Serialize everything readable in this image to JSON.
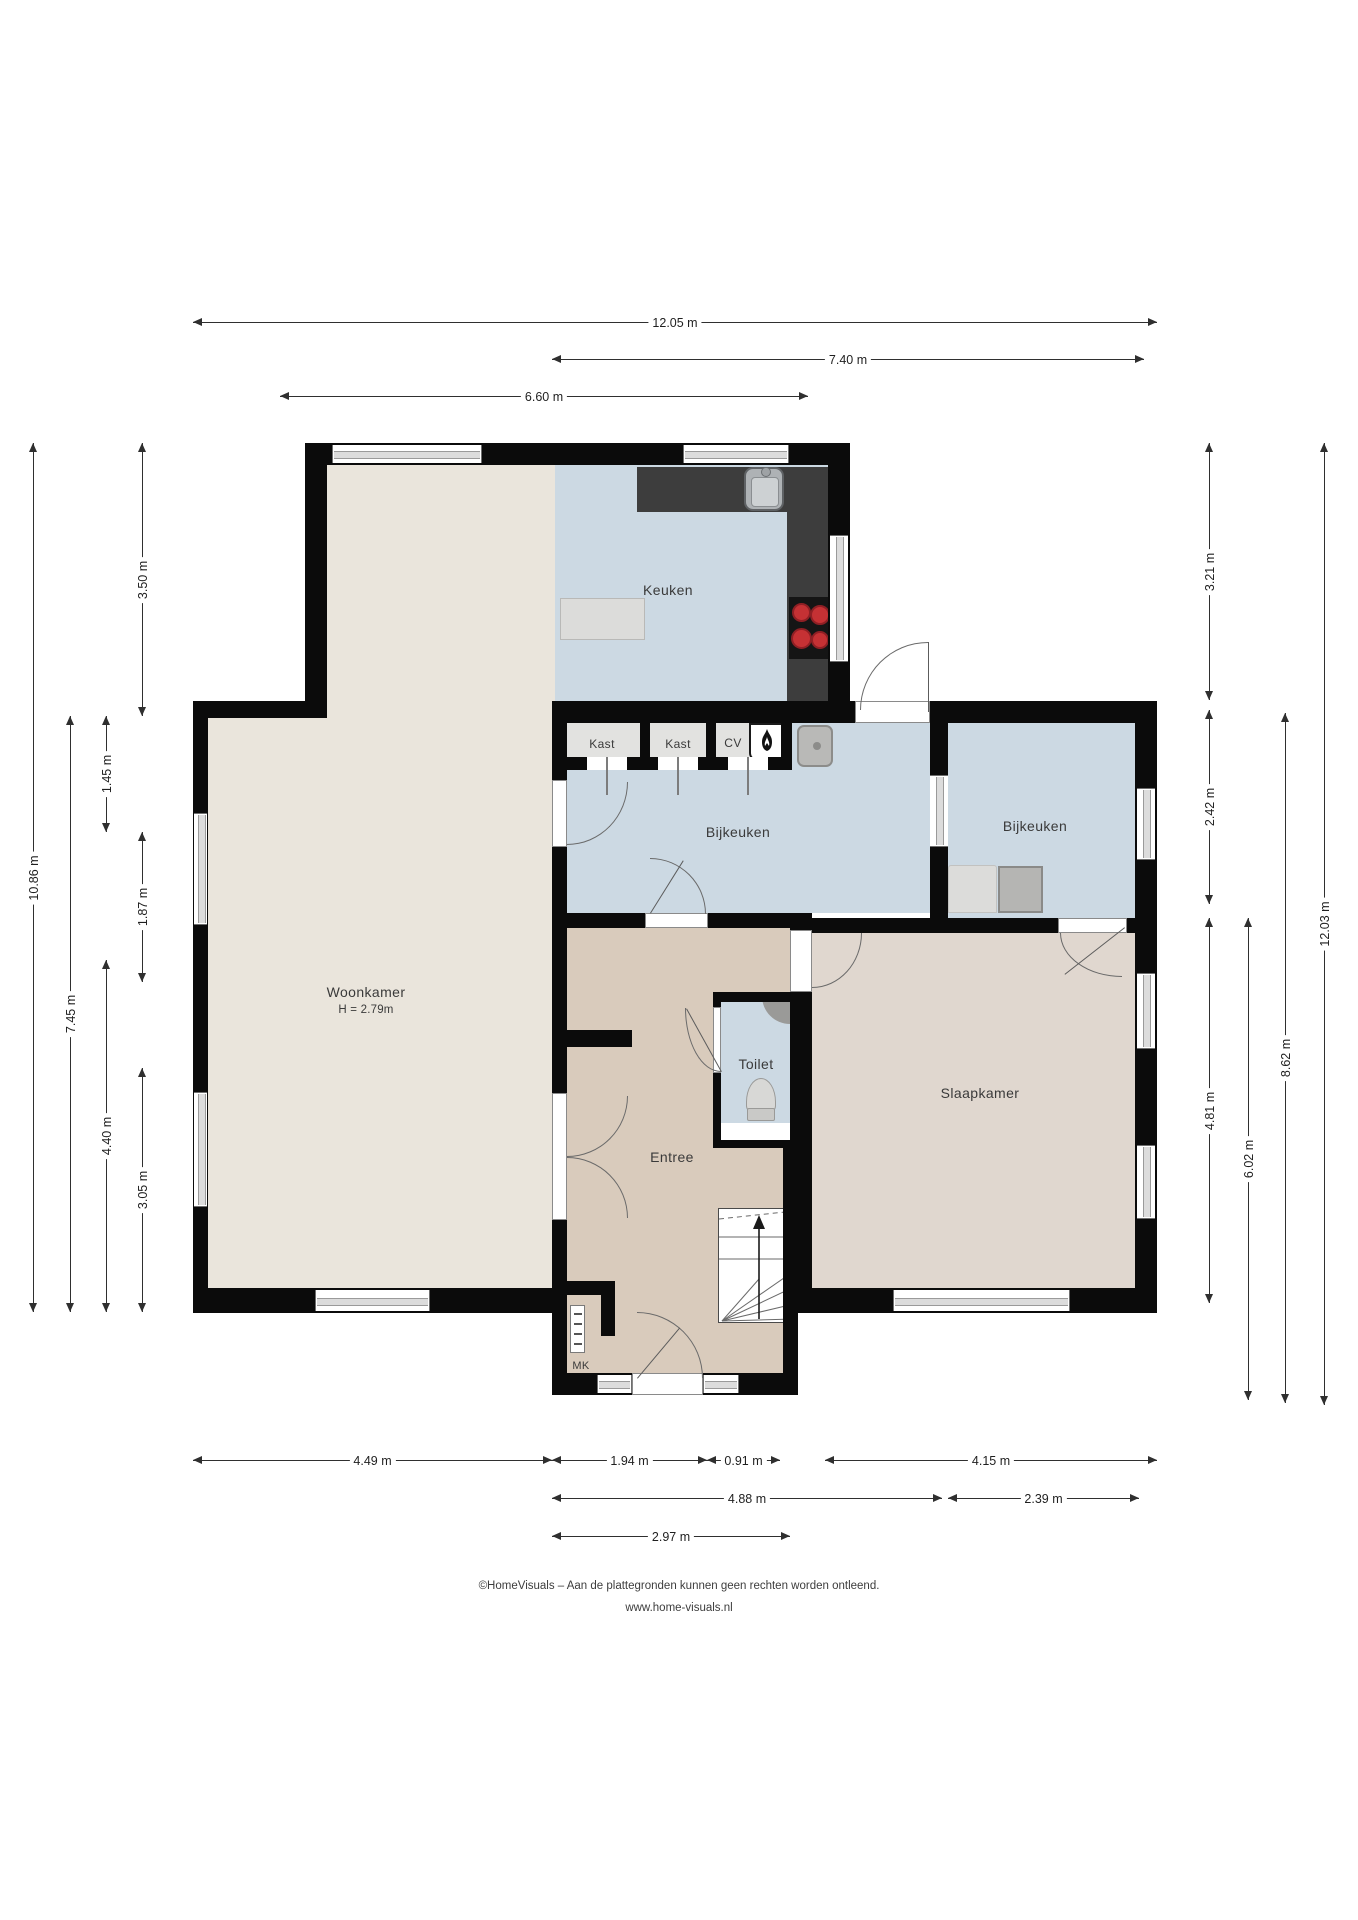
{
  "plan": {
    "rooms": [
      {
        "id": "woonkamer",
        "label": "Woonkamer",
        "note": "H = 2.79m"
      },
      {
        "id": "keuken",
        "label": "Keuken"
      },
      {
        "id": "bijkeuken-left",
        "label": "Bijkeuken"
      },
      {
        "id": "bijkeuken-right",
        "label": "Bijkeuken"
      },
      {
        "id": "entree",
        "label": "Entree"
      },
      {
        "id": "toilet",
        "label": "Toilet"
      },
      {
        "id": "slaapkamer",
        "label": "Slaapkamer"
      },
      {
        "id": "kast-1",
        "label": "Kast"
      },
      {
        "id": "kast-2",
        "label": "Kast"
      },
      {
        "id": "cv",
        "label": "CV"
      },
      {
        "id": "mk",
        "label": "MK"
      }
    ],
    "dimensions": {
      "top": [
        {
          "label": "12.05 m"
        },
        {
          "label": "7.40 m"
        },
        {
          "label": "6.60 m"
        }
      ],
      "left": [
        {
          "label": "10.86 m"
        },
        {
          "label": "7.45 m"
        },
        {
          "label": "1.45 m"
        },
        {
          "label": "4.40 m"
        },
        {
          "label": "3.50 m"
        },
        {
          "label": "1.87 m"
        },
        {
          "label": "3.05 m"
        }
      ],
      "right": [
        {
          "label": "3.21 m"
        },
        {
          "label": "2.42 m"
        },
        {
          "label": "4.81 m"
        },
        {
          "label": "6.02 m"
        },
        {
          "label": "8.62 m"
        },
        {
          "label": "12.03 m"
        }
      ],
      "bottom": [
        {
          "label": "4.49 m"
        },
        {
          "label": "1.94 m"
        },
        {
          "label": "0.91 m"
        },
        {
          "label": "4.15 m"
        },
        {
          "label": "4.88 m"
        },
        {
          "label": "2.39 m"
        },
        {
          "label": "2.97 m"
        }
      ]
    },
    "footer": {
      "line1": "©HomeVisuals – Aan de plattegronden kunnen geen rechten worden ontleend.",
      "line2": "www.home-visuals.nl"
    },
    "colors": {
      "wall": "#0b0b0b",
      "living_floor": "#eae5dc",
      "wet_room_floor": "#ccd9e3",
      "hall_floor": "#d9cbbc",
      "bedroom_floor": "#e0d7cf",
      "counter": "#3d3d3d",
      "burner": "#c53134"
    }
  }
}
